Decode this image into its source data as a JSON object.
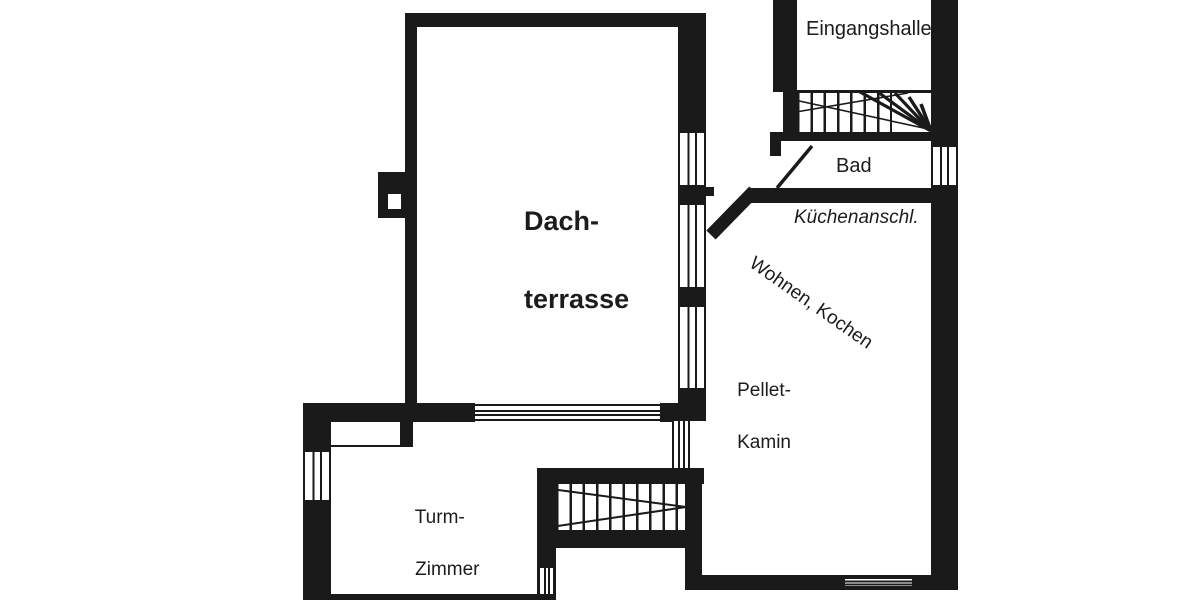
{
  "plan": {
    "type": "floor-plan-scan",
    "language": "de",
    "labels": {
      "eingangshalle": "Eingangshalle",
      "bad": "Bad",
      "kuechenanschluss": "Küchenanschl.",
      "wohnen_kochen": "Wohnen, Kochen",
      "pellet_line1": "Pellet-",
      "pellet_line2": "Kamin",
      "dach_line1": "Dach-",
      "dach_line2": "terrasse",
      "turm_line1": "Turm-",
      "turm_line2": "Zimmer"
    },
    "colors": {
      "wall": "#1a1a1a",
      "background": "#ffffff"
    }
  }
}
